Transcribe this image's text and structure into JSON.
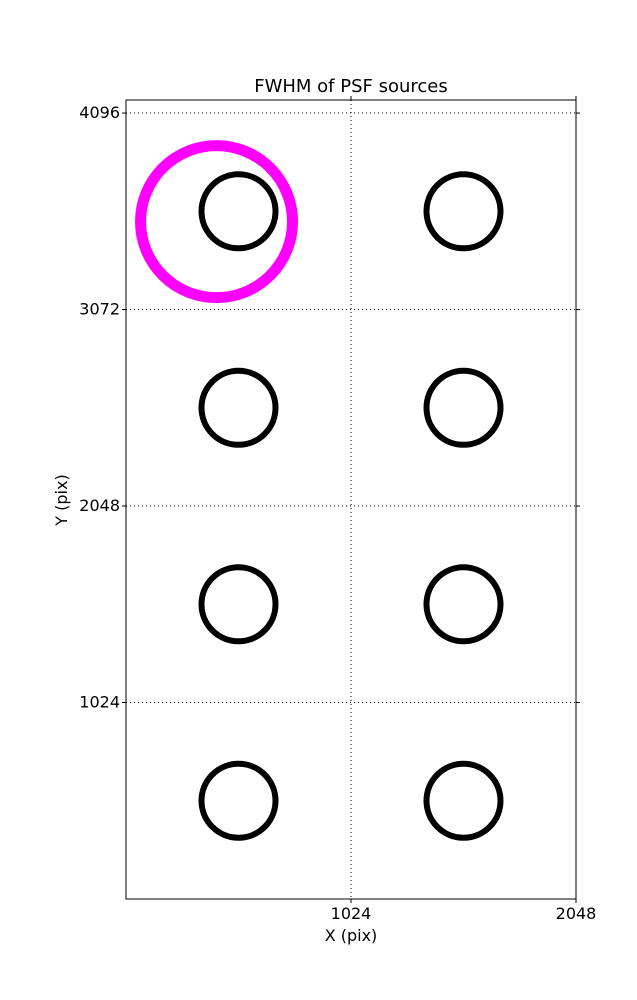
{
  "chart_data": {
    "type": "scatter",
    "title": "FWHM of PSF sources",
    "xlabel": "X (pix)",
    "ylabel": "Y (pix)",
    "xlim": [
      0,
      2048
    ],
    "ylim": [
      0,
      4164
    ],
    "xticks": [
      1024,
      2048
    ],
    "yticks": [
      1024,
      2048,
      3072,
      4096
    ],
    "grid": {
      "visible": true,
      "style": "dotted",
      "color": "#000000"
    },
    "background_color": "#ffffff",
    "axis_color": "#000000",
    "series": [
      {
        "name": "psf-source",
        "marker": "open-circle",
        "color": "#000000",
        "marker_radius_px": 37,
        "stroke_width_px": 6,
        "points": [
          {
            "x": 512,
            "y": 3584
          },
          {
            "x": 1536,
            "y": 3584
          },
          {
            "x": 512,
            "y": 2560
          },
          {
            "x": 1536,
            "y": 2560
          },
          {
            "x": 512,
            "y": 1536
          },
          {
            "x": 1536,
            "y": 1536
          },
          {
            "x": 512,
            "y": 512
          },
          {
            "x": 1536,
            "y": 512
          }
        ]
      },
      {
        "name": "highlighted-source",
        "marker": "open-circle",
        "color": "#ff00ff",
        "marker_radius_px": 76,
        "stroke_width_px": 11,
        "points": [
          {
            "x": 412,
            "y": 3530
          }
        ]
      }
    ]
  }
}
